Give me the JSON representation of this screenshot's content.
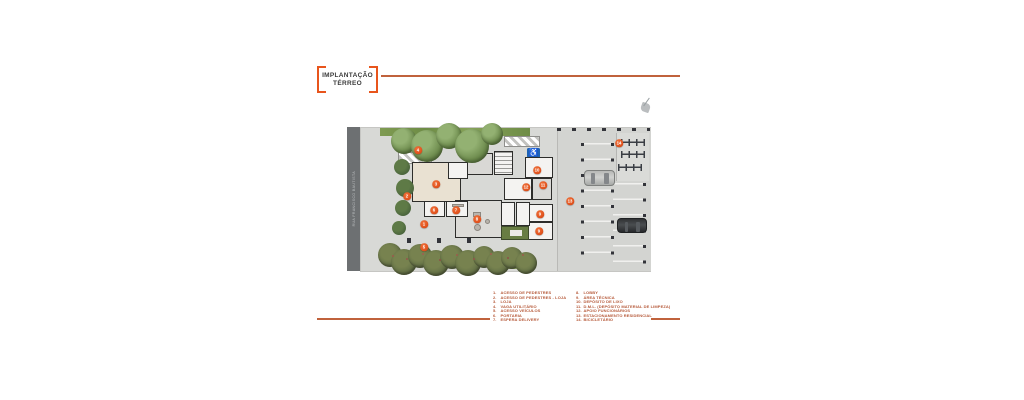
{
  "title": {
    "line1": "IMPLANTAÇÃO",
    "line2": "TÉRREO"
  },
  "street": {
    "label": "RUA FRANCISCO BAUTISTA"
  },
  "colors": {
    "accent_orange": "#e8551c",
    "marker_orange": "#e2541f",
    "rule_orange": "#c0623c",
    "legend_text": "#b65a3a",
    "sign_blue": "#1e63b4",
    "street_gray": "#6d7072",
    "pavement_gray": "#d8d9d6",
    "loja_floor_beige": "#e9e1d2"
  },
  "icons": {
    "wheelchair": "♿"
  },
  "markers": {
    "m1": "1",
    "m2": "2",
    "m3": "3",
    "m4": "4",
    "m5": "5",
    "m6": "6",
    "m7": "7",
    "m8": "8",
    "m9": "9",
    "m9b": "9",
    "m10": "10",
    "m11": "11",
    "m12": "12",
    "m13": "13",
    "m14": "14"
  },
  "legend": {
    "columns": [
      {
        "items": [
          {
            "num": "1.",
            "text": "ACESSO DE PEDESTRES"
          },
          {
            "num": "2.",
            "text": "ACESSO DE PEDESTRES - LOJA"
          },
          {
            "num": "3.",
            "text": "LOJA"
          },
          {
            "num": "4.",
            "text": "VAGA UTILITÁRIO"
          },
          {
            "num": "5.",
            "text": "ACESSO VEÍCULOS"
          },
          {
            "num": "6.",
            "text": "PORTARIA"
          },
          {
            "num": "7.",
            "text": "ESPERA DELIVERY"
          }
        ]
      },
      {
        "items": [
          {
            "num": "8.",
            "text": "LOBBY"
          },
          {
            "num": "9.",
            "text": "ÁREA TÉCNICA"
          },
          {
            "num": "10.",
            "text": "DEPÓSITO DE LIXO"
          },
          {
            "num": "11.",
            "text": "D.M.L. (DEPÓSITO MATERIAL DE LIMPEZA)"
          },
          {
            "num": "12.",
            "text": "APOIO FUNCIONÁRIOS"
          },
          {
            "num": "13.",
            "text": "ESTACIONAMENTO RESIDENCIAL"
          },
          {
            "num": "14.",
            "text": "BICICLETÁRIO"
          }
        ]
      }
    ]
  }
}
